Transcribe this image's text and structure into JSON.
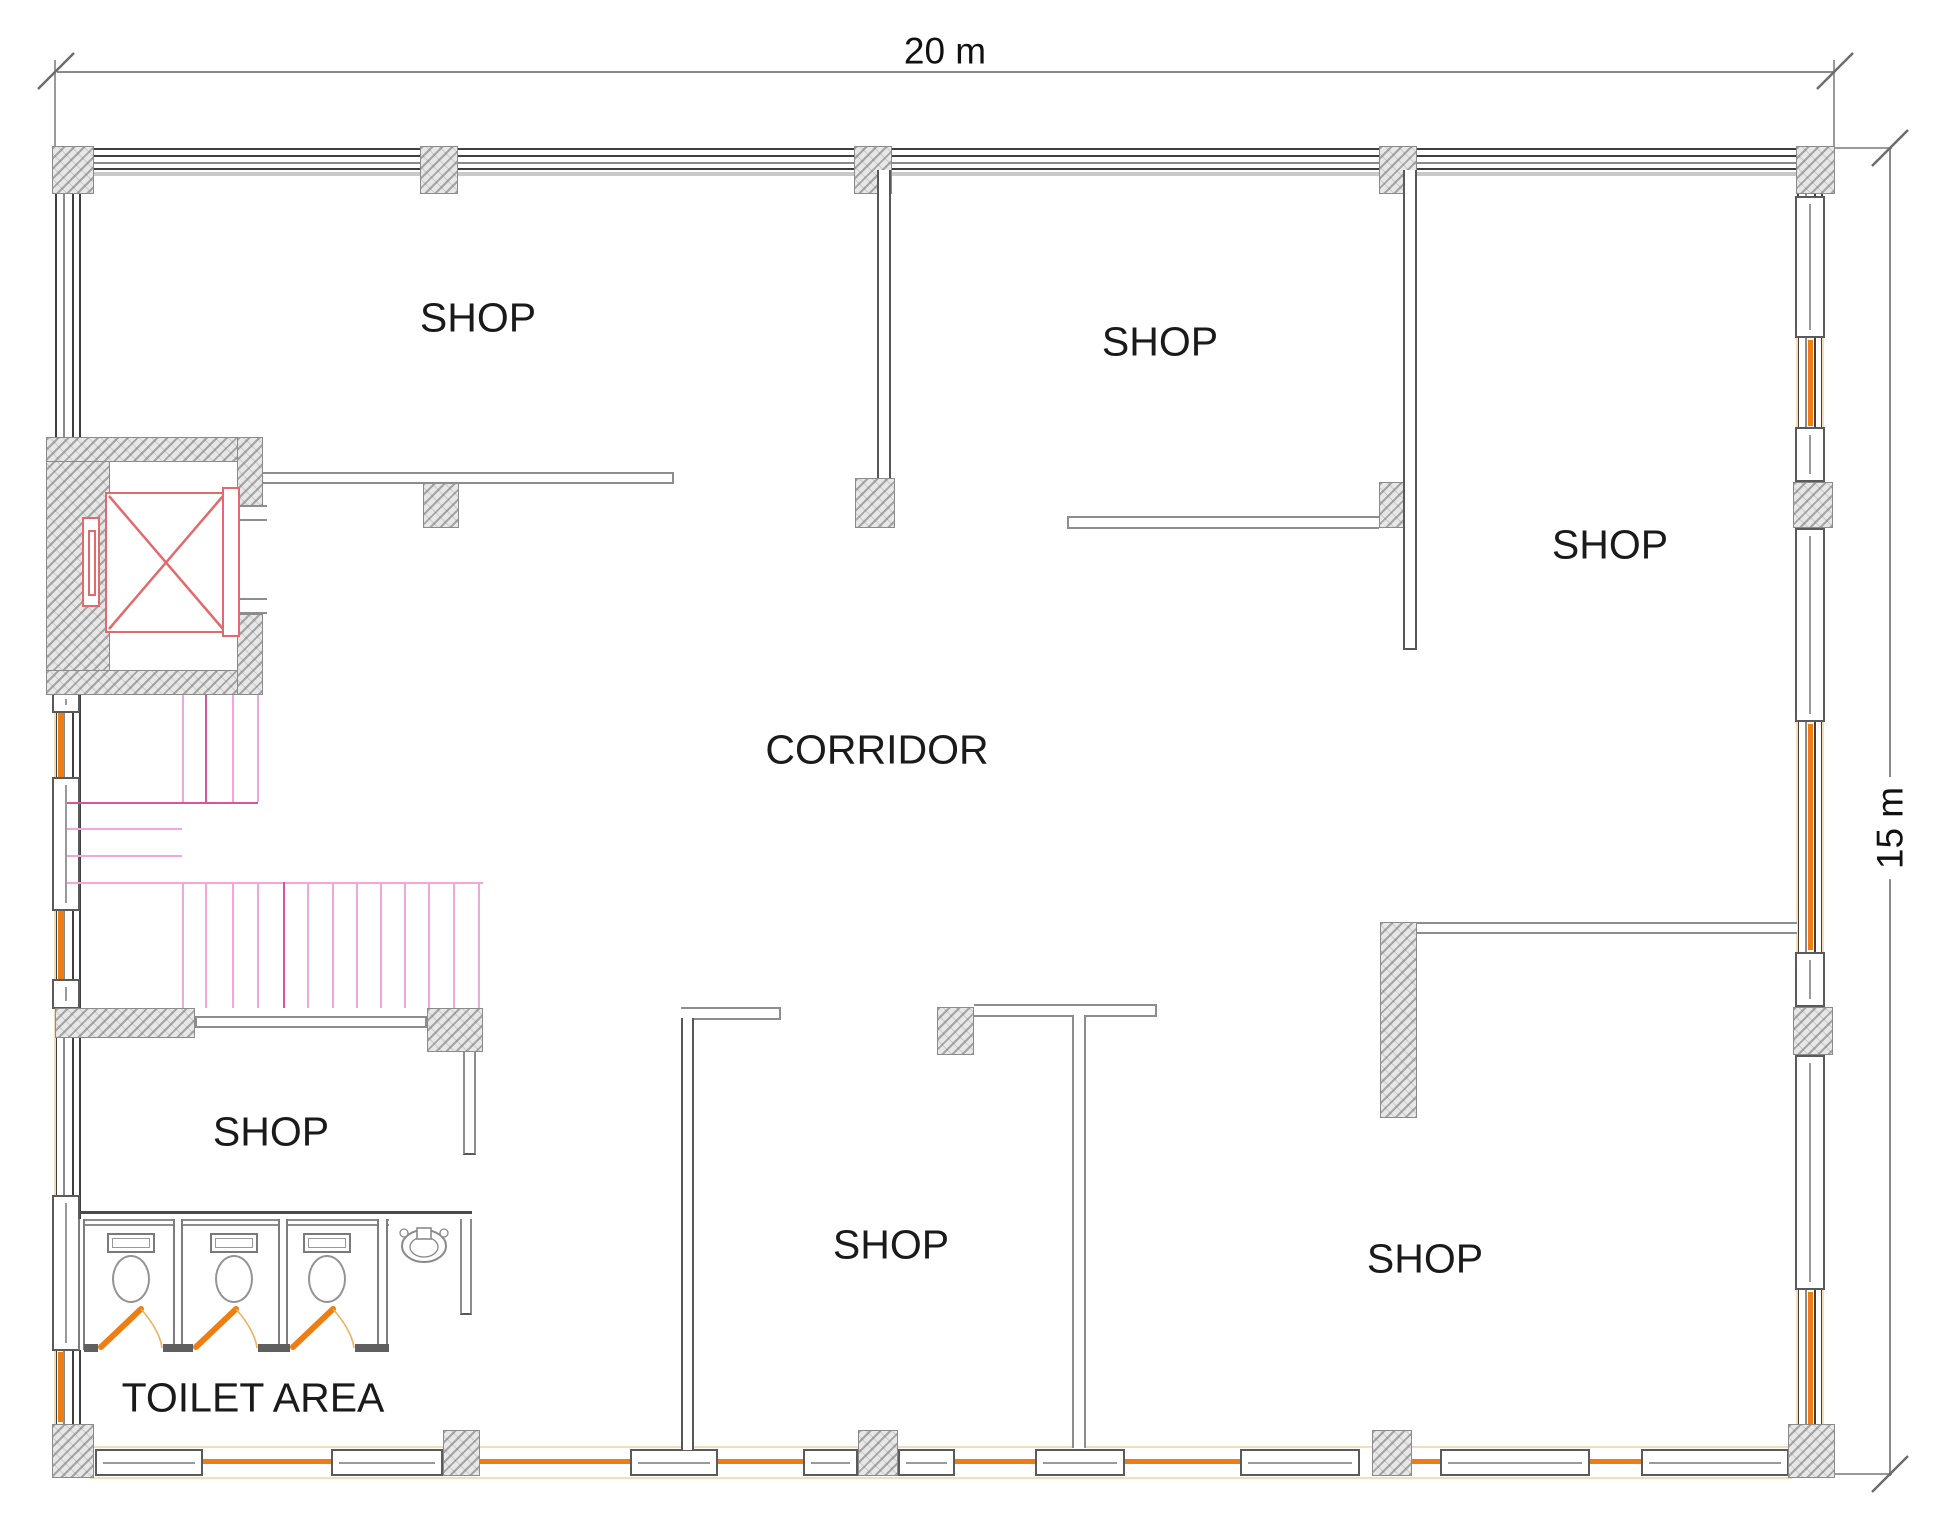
{
  "drawing": {
    "type": "floor-plan",
    "title": "shop floor layout with corridor, toilet area, staircase and elevator"
  },
  "dimensions": {
    "width_label": "20 m",
    "height_label": "15 m"
  },
  "rooms": [
    {
      "id": "shop-top-left",
      "label": "SHOP"
    },
    {
      "id": "shop-top-middle",
      "label": "SHOP"
    },
    {
      "id": "shop-right",
      "label": "SHOP"
    },
    {
      "id": "corridor",
      "label": "CORRIDOR"
    },
    {
      "id": "shop-left-middle",
      "label": "SHOP"
    },
    {
      "id": "shop-bottom-middle",
      "label": "SHOP"
    },
    {
      "id": "shop-bottom-right",
      "label": "SHOP"
    },
    {
      "id": "toilet-area",
      "label": "TOILET AREA"
    }
  ],
  "fixtures": {
    "elevator": "elevator with X car symbol",
    "staircase": "u-shaped staircase",
    "toilet_stalls": 3,
    "wash_basin": 1
  },
  "colors": {
    "glazing_orange": "#F07D12",
    "glazing_pale": "#F8DCB4",
    "stair_pink": "#F2A6DA",
    "stair_magenta": "#D5569F",
    "elevator_red": "#E36A6A",
    "wall_dark": "#3F3F3F",
    "wall_gray": "#8A8A8A",
    "hatch_bg": "#E7E7E7",
    "label_color": "#1A1A1A"
  }
}
